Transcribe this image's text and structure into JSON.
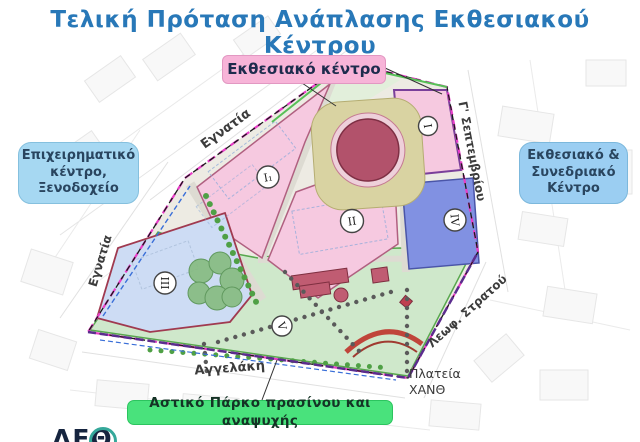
{
  "title": "Τελική  Πρόταση  Ανάπλασης  Εκθεσιακού  Κέντρου",
  "callouts": {
    "exhibition_center": "Εκθεσιακό κέντρο",
    "business_center": "Επιχειρηματικό\nκέντρο,\nΞενοδοχείο",
    "exhibition_conference": "Εκθεσιακό &\nΣυνεδριακό\nΚέντρο",
    "urban_park": "Αστικό  Πάρκο  πρασίνου  και αναψυχής"
  },
  "map": {
    "streets": [
      {
        "name": "Εγνατία"
      },
      {
        "name": "Εγνατία"
      },
      {
        "name": "Γ' Σεπτεμβρίου"
      },
      {
        "name": "Λεωφ. Στρατού"
      },
      {
        "name": "Αγγελάκη"
      }
    ],
    "plateia": "Πλατεία\nΧΑΝΘ",
    "zones": [
      {
        "id": "I1",
        "label": "Ι₁"
      },
      {
        "id": "II",
        "label": "ΙΙ"
      },
      {
        "id": "III",
        "label": "ΙΙΙ"
      },
      {
        "id": "IV",
        "label": "ΙV"
      },
      {
        "id": "V",
        "label": "V"
      },
      {
        "id": "I",
        "label": "Ι"
      }
    ]
  },
  "logo": {
    "text": "ΔΕΘ"
  },
  "colors": {
    "title": "#2878b8",
    "callout_pink": "#f7b4d8",
    "callout_cyan": "#a6d8f2",
    "callout_green": "#49e27c",
    "boundary_magenta": "#e83ec8",
    "boundary_purple": "#5b2d8e",
    "park_green": "#cfe8cb",
    "zone_pink": "#f6c9e0",
    "zone_blue": "#8191e2",
    "zone_lightblue": "#cddcf4",
    "stadium_red": "#b2526b"
  }
}
